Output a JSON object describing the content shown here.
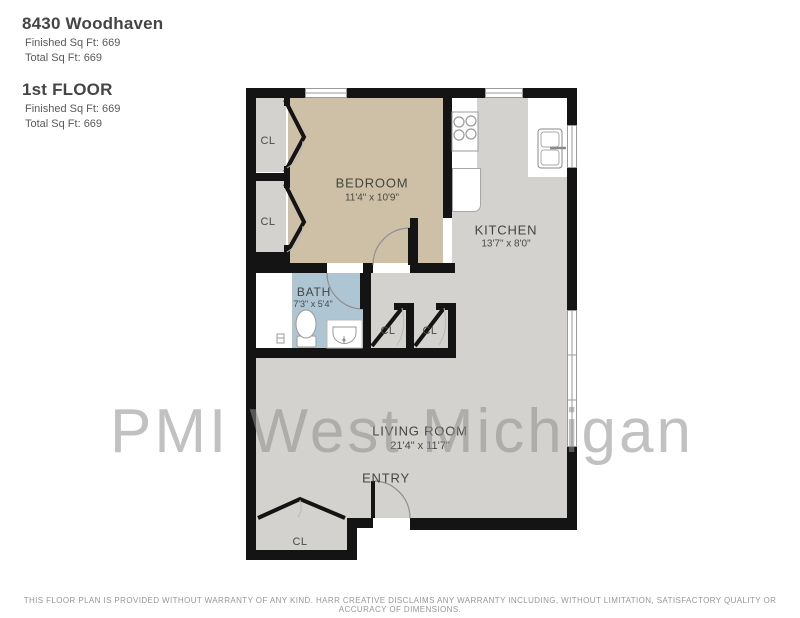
{
  "header": {
    "address": "8430 Woodhaven",
    "address_finished": "Finished Sq Ft: 669",
    "address_total": "Total Sq Ft: 669",
    "floor_name": "1st FLOOR",
    "floor_finished": "Finished Sq Ft: 669",
    "floor_total": "Total Sq Ft: 669"
  },
  "watermark": "PMI West Michigan",
  "rooms": {
    "bedroom": {
      "name": "BEDROOM",
      "dims": "11'4\" x 10'9\""
    },
    "kitchen": {
      "name": "KITCHEN",
      "dims": "13'7\" x 8'0\""
    },
    "bath": {
      "name": "BATH",
      "dims": "7'3\" x 5'4\""
    },
    "living_room": {
      "name": "LIVING ROOM",
      "dims": "21'4\" x 11'7\""
    },
    "entry": {
      "name": "ENTRY"
    },
    "closet_label": "CL"
  },
  "colors": {
    "bedroom_floor": "#cdc0a7",
    "kitchen_living_floor": "#d3d2ce",
    "bath_floor": "#aec6d4",
    "wall": "#141414",
    "watermark": "#8f8f8f"
  },
  "footer": {
    "disclaimer": "THIS FLOOR PLAN IS PROVIDED WITHOUT WARRANTY OF ANY KIND. HARR CREATIVE DISCLAIMS ANY WARRANTY INCLUDING, WITHOUT LIMITATION, SATISFACTORY QUALITY OR ACCURACY OF DIMENSIONS."
  }
}
